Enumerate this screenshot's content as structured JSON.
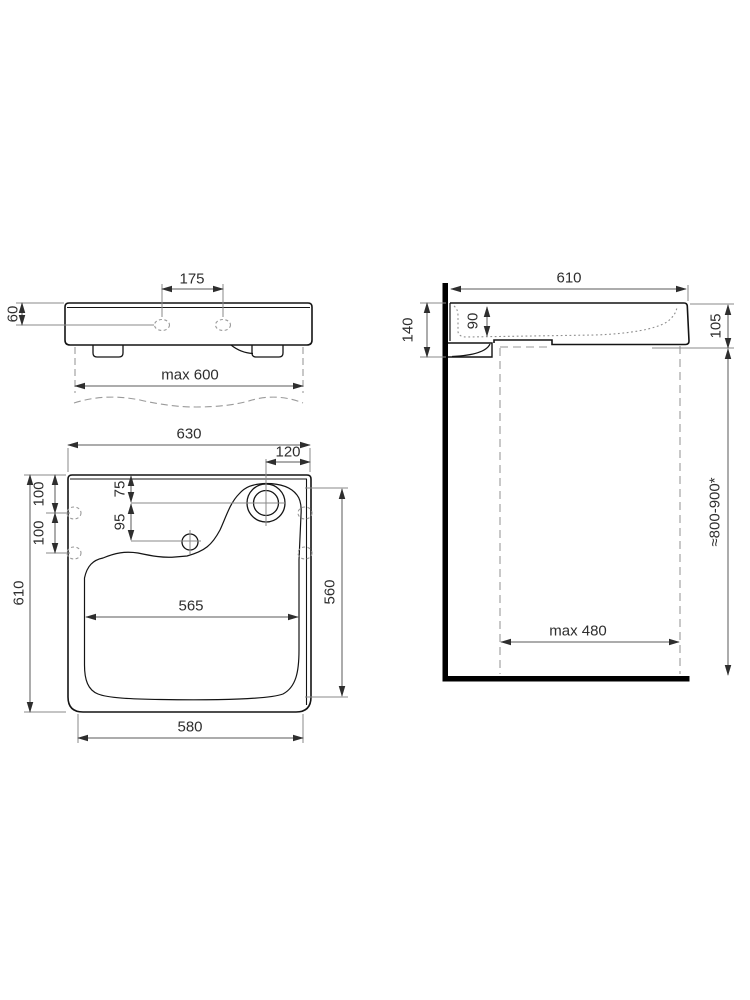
{
  "colors": {
    "background": "#ffffff",
    "outline": "#141414",
    "dimension_line": "#5a5a5a",
    "extension_line": "#8a8a8a",
    "hidden_line": "#9a9a9a",
    "text": "#2e2e2e"
  },
  "views": {
    "front": {
      "tap_hole_spacing": "175",
      "hole_height_from_top": "60",
      "max_width": "max 600"
    },
    "side": {
      "depth": "610",
      "back_height": "140",
      "bowl_inner_depth": "90",
      "front_edge_height": "105",
      "installation_height": "≈800-900*",
      "max_clearance": "max 480"
    },
    "plan": {
      "overall_width": "630",
      "drain_offset_from_right": "120",
      "side_hole_pitch_1": "100",
      "side_hole_pitch_2": "100",
      "overall_depth": "610",
      "drain_from_back": "75",
      "overflow_from_drain": "95",
      "bowl_width": "565",
      "bowl_depth": "560",
      "base_width": "580"
    }
  }
}
